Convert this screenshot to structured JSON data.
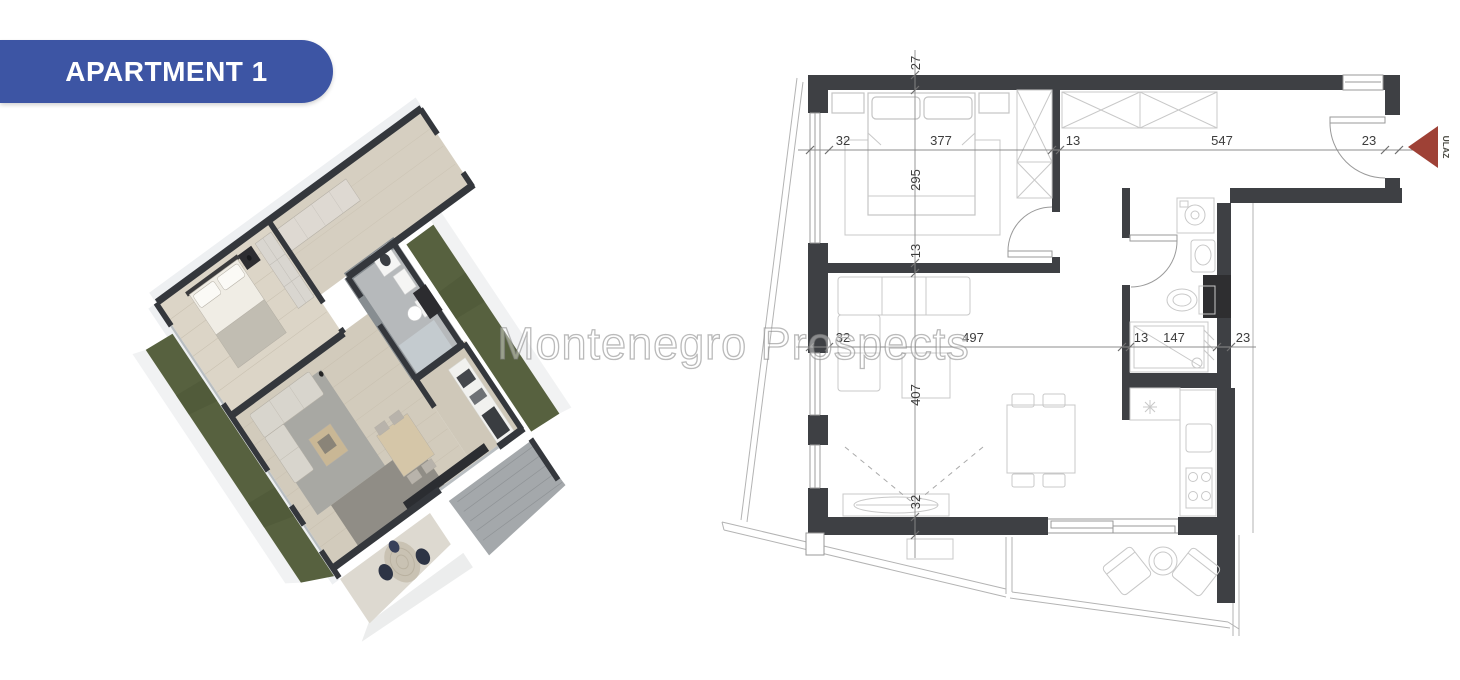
{
  "badge": {
    "label": "APARTMENT 1",
    "bg_color": "#3D55A4",
    "text_color": "#FFFFFF"
  },
  "watermark": {
    "text": "Montenegro Prospects"
  },
  "plan2d": {
    "wall_color": "#3E4044",
    "entrance": {
      "label": "ULAZ",
      "arrow_color": "#9E4136"
    },
    "dims": {
      "top": [
        "32",
        "377",
        "13",
        "547",
        "23"
      ],
      "left": [
        "27",
        "295",
        "13",
        "407",
        "32"
      ],
      "middle": [
        "32",
        "497",
        "13",
        "147",
        "23"
      ]
    }
  },
  "plan3d": {
    "wall_color": "#34373C",
    "floor_wood": "#DCD5C7",
    "bathroom_tile": "#878D91",
    "grass": "#57613F",
    "rug": "#A8A8A3",
    "balcony_chair": "#2D3445"
  }
}
